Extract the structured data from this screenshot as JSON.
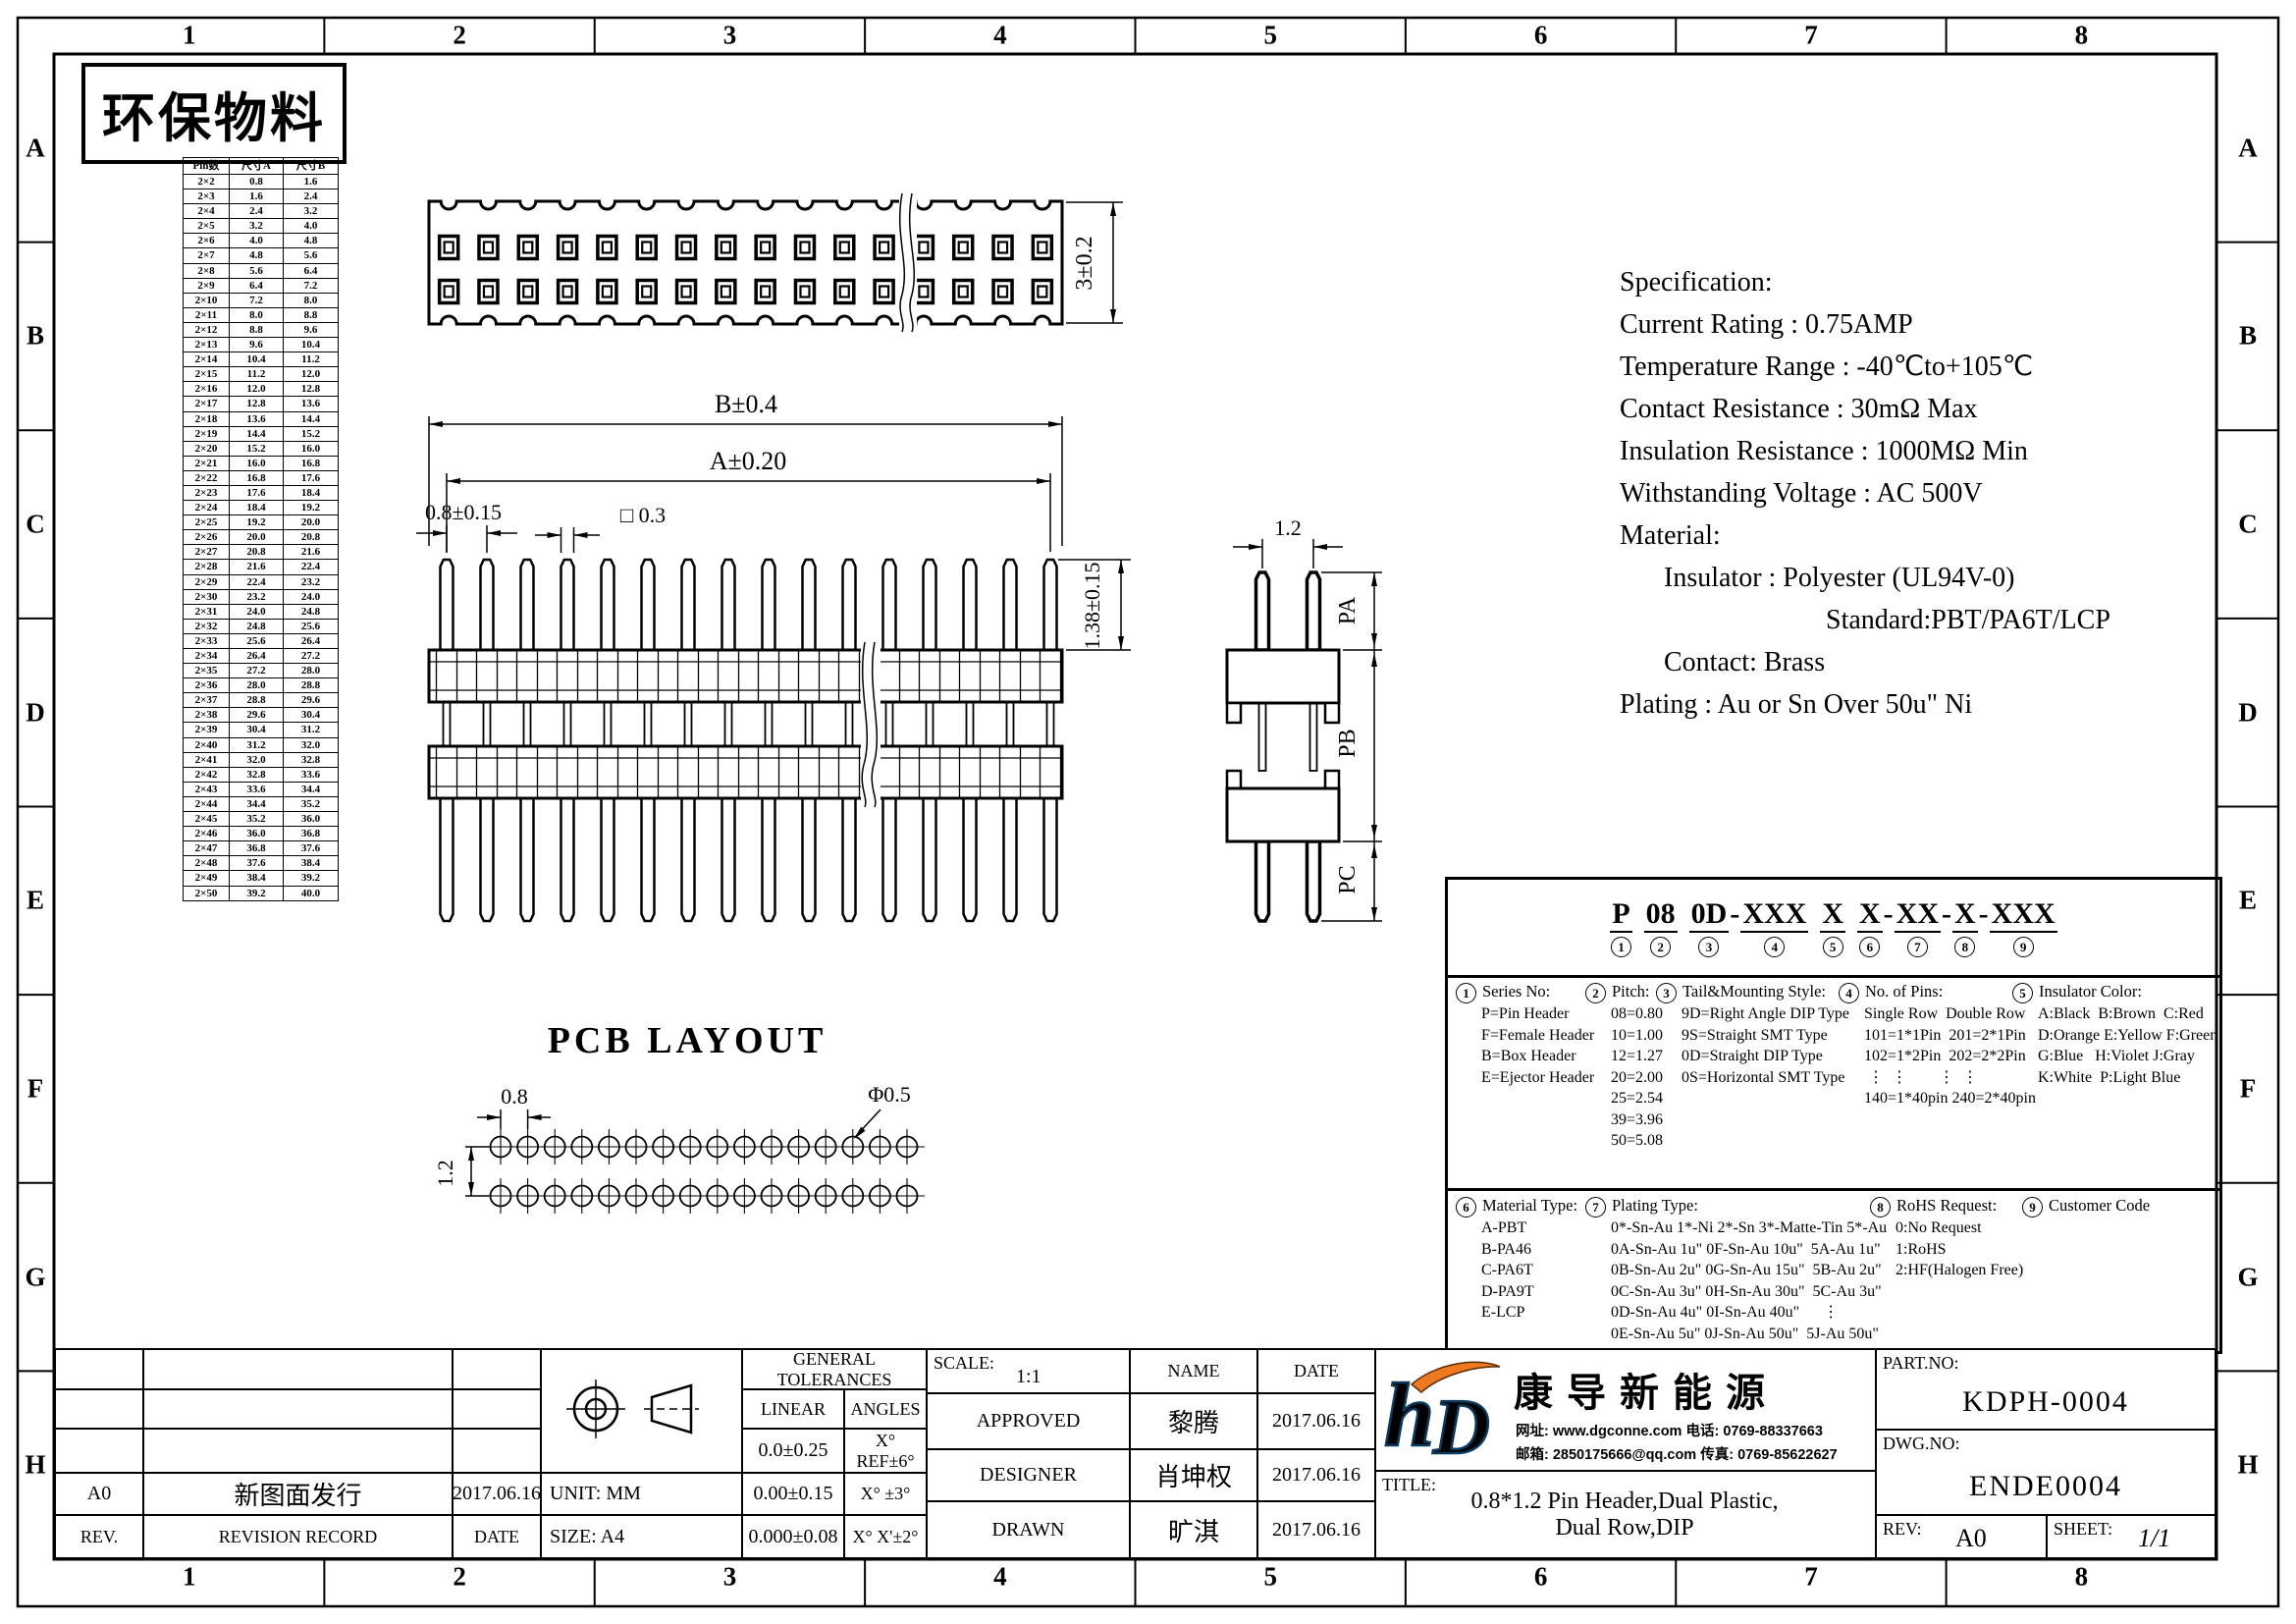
{
  "stamp": {
    "text": "环保物料"
  },
  "zones": {
    "columns": [
      "1",
      "2",
      "3",
      "4",
      "5",
      "6",
      "7",
      "8"
    ],
    "rows": [
      "A",
      "B",
      "C",
      "D",
      "E",
      "F",
      "G",
      "H"
    ]
  },
  "pin_table": {
    "headers": [
      "Pin数",
      "尺寸A",
      "尺寸B"
    ],
    "rows": [
      [
        "2×2",
        "0.8",
        "1.6"
      ],
      [
        "2×3",
        "1.6",
        "2.4"
      ],
      [
        "2×4",
        "2.4",
        "3.2"
      ],
      [
        "2×5",
        "3.2",
        "4.0"
      ],
      [
        "2×6",
        "4.0",
        "4.8"
      ],
      [
        "2×7",
        "4.8",
        "5.6"
      ],
      [
        "2×8",
        "5.6",
        "6.4"
      ],
      [
        "2×9",
        "6.4",
        "7.2"
      ],
      [
        "2×10",
        "7.2",
        "8.0"
      ],
      [
        "2×11",
        "8.0",
        "8.8"
      ],
      [
        "2×12",
        "8.8",
        "9.6"
      ],
      [
        "2×13",
        "9.6",
        "10.4"
      ],
      [
        "2×14",
        "10.4",
        "11.2"
      ],
      [
        "2×15",
        "11.2",
        "12.0"
      ],
      [
        "2×16",
        "12.0",
        "12.8"
      ],
      [
        "2×17",
        "12.8",
        "13.6"
      ],
      [
        "2×18",
        "13.6",
        "14.4"
      ],
      [
        "2×19",
        "14.4",
        "15.2"
      ],
      [
        "2×20",
        "15.2",
        "16.0"
      ],
      [
        "2×21",
        "16.0",
        "16.8"
      ],
      [
        "2×22",
        "16.8",
        "17.6"
      ],
      [
        "2×23",
        "17.6",
        "18.4"
      ],
      [
        "2×24",
        "18.4",
        "19.2"
      ],
      [
        "2×25",
        "19.2",
        "20.0"
      ],
      [
        "2×26",
        "20.0",
        "20.8"
      ],
      [
        "2×27",
        "20.8",
        "21.6"
      ],
      [
        "2×28",
        "21.6",
        "22.4"
      ],
      [
        "2×29",
        "22.4",
        "23.2"
      ],
      [
        "2×30",
        "23.2",
        "24.0"
      ],
      [
        "2×31",
        "24.0",
        "24.8"
      ],
      [
        "2×32",
        "24.8",
        "25.6"
      ],
      [
        "2×33",
        "25.6",
        "26.4"
      ],
      [
        "2×34",
        "26.4",
        "27.2"
      ],
      [
        "2×35",
        "27.2",
        "28.0"
      ],
      [
        "2×36",
        "28.0",
        "28.8"
      ],
      [
        "2×37",
        "28.8",
        "29.6"
      ],
      [
        "2×38",
        "29.6",
        "30.4"
      ],
      [
        "2×39",
        "30.4",
        "31.2"
      ],
      [
        "2×40",
        "31.2",
        "32.0"
      ],
      [
        "2×41",
        "32.0",
        "32.8"
      ],
      [
        "2×42",
        "32.8",
        "33.6"
      ],
      [
        "2×43",
        "33.6",
        "34.4"
      ],
      [
        "2×44",
        "34.4",
        "35.2"
      ],
      [
        "2×45",
        "35.2",
        "36.0"
      ],
      [
        "2×46",
        "36.0",
        "36.8"
      ],
      [
        "2×47",
        "36.8",
        "37.6"
      ],
      [
        "2×48",
        "37.6",
        "38.4"
      ],
      [
        "2×49",
        "38.4",
        "39.2"
      ],
      [
        "2×50",
        "39.2",
        "40.0"
      ]
    ]
  },
  "views": {
    "top": {
      "height_dim": "3±0.2"
    },
    "front": {
      "dim_b": "B±0.4",
      "dim_a": "A±0.20",
      "dim_pitch": "0.8±0.15",
      "dim_pin": "□ 0.3",
      "dim_h": "1.38±0.15"
    },
    "side": {
      "dim_w": "1.2",
      "dim_pa": "PA",
      "dim_pb": "PB",
      "dim_pc": "PC"
    },
    "pcb": {
      "title": "PCB  LAYOUT",
      "dim_pitch": "0.8",
      "dim_row": "1.2",
      "dim_hole": "Φ0.5"
    }
  },
  "spec": {
    "lines": [
      {
        "text": "Specification:",
        "indent": 0
      },
      {
        "text": "Current Rating : 0.75AMP",
        "indent": 0
      },
      {
        "text": "Temperature Range : -40℃to+105℃",
        "indent": 0
      },
      {
        "text": "Contact Resistance : 30mΩ Max",
        "indent": 0
      },
      {
        "text": "Insulation Resistance : 1000MΩ Min",
        "indent": 0
      },
      {
        "text": "Withstanding Voltage : AC 500V",
        "indent": 0
      },
      {
        "text": "Material:",
        "indent": 0
      },
      {
        "text": "Insulator : Polyester (UL94V-0)",
        "indent": 1
      },
      {
        "text": "Standard:PBT/PA6T/LCP",
        "indent": 2
      },
      {
        "text": "Contact: Brass",
        "indent": 1
      },
      {
        "text": "Plating : Au or Sn Over 50u\" Ni",
        "indent": 0
      }
    ]
  },
  "ordering": {
    "code_groups": [
      {
        "text": "P",
        "num": "1",
        "sep": " "
      },
      {
        "text": "08",
        "num": "2",
        "sep": " "
      },
      {
        "text": "0D",
        "num": "3",
        "sep": "-"
      },
      {
        "text": "XXX",
        "num": "4",
        "sep": " "
      },
      {
        "text": "X",
        "num": "5",
        "sep": " "
      },
      {
        "text": "X",
        "num": "6",
        "sep": "-"
      },
      {
        "text": "XX",
        "num": "7",
        "sep": "-"
      },
      {
        "text": "X",
        "num": "8",
        "sep": "-"
      },
      {
        "text": "XXX",
        "num": "9",
        "sep": ""
      }
    ],
    "series": {
      "num": "1",
      "title": "Series No:",
      "items": [
        "P=Pin Header",
        "F=Female Header",
        "B=Box Header",
        "E=Ejector Header"
      ]
    },
    "pitch": {
      "num": "2",
      "title": "Pitch:",
      "items": [
        "08=0.80",
        "10=1.00",
        "12=1.27",
        "20=2.00",
        "25=2.54",
        "39=3.96",
        "50=5.08"
      ]
    },
    "tail": {
      "num": "3",
      "title": "Tail&Mounting Style:",
      "items": [
        "9D=Right Angle DIP Type",
        "9S=Straight SMT Type",
        "0D=Straight DIP Type",
        "0S=Horizontal SMT Type"
      ]
    },
    "pins": {
      "num": "4",
      "title": "No. of Pins:",
      "lines": [
        "Single Row  Double Row",
        "101=1*1Pin  201=2*1Pin",
        "102=1*2Pin  202=2*2Pin",
        " ⋮  ⋮        ⋮  ⋮",
        "140=1*40pin 240=2*40pin"
      ]
    },
    "color": {
      "num": "5",
      "title": "Insulator Color:",
      "lines": [
        "A:Black  B:Brown  C:Red",
        "D:Orange E:Yellow F:Green",
        "G:Blue   H:Violet J:Gray",
        "K:White  P:Light Blue"
      ]
    },
    "material": {
      "num": "6",
      "title": "Material Type:",
      "items": [
        "A-PBT",
        "B-PA46",
        "C-PA6T",
        "D-PA9T",
        "E-LCP"
      ]
    },
    "plating": {
      "num": "7",
      "title": "Plating Type:",
      "lines": [
        "0*-Sn-Au 1*-Ni 2*-Sn 3*-Matte-Tin 5*-Au",
        "0A-Sn-Au 1u\" 0F-Sn-Au 10u\"  5A-Au 1u\"",
        "0B-Sn-Au 2u\" 0G-Sn-Au 15u\"  5B-Au 2u\"",
        "0C-Sn-Au 3u\" 0H-Sn-Au 30u\"  5C-Au 3u\"",
        "0D-Sn-Au 4u\" 0I-Sn-Au 40u\"      ⋮",
        "0E-Sn-Au 5u\" 0J-Sn-Au 50u\"  5J-Au 50u\""
      ]
    },
    "rohs": {
      "num": "8",
      "title": "RoHS Request:",
      "items": [
        "0:No Request",
        "1:RoHS",
        "2:HF(Halogen Free)"
      ]
    },
    "customer": {
      "num": "9",
      "title": "Customer Code"
    }
  },
  "title_block": {
    "revision": {
      "rev": "A0",
      "record": "新图面发行",
      "date": "2017.06.16",
      "rev_header": "REV.",
      "record_header": "REVISION RECORD",
      "date_header": "DATE"
    },
    "unit_label": "UNIT: MM",
    "size_label": "SIZE: A4",
    "tolerances": {
      "title": "GENERAL TOLERANCES",
      "linear_label": "LINEAR",
      "angles_label": "ANGLES",
      "rows": [
        [
          "0.0±0.25",
          "X° REF±6°"
        ],
        [
          "0.00±0.15",
          "X° ±3°"
        ],
        [
          "0.000±0.08",
          "X° X'±2°"
        ]
      ]
    },
    "scale_label": "SCALE:",
    "scale_value": "1:1",
    "name_header": "NAME",
    "date_header": "DATE",
    "sign_rows": [
      {
        "role": "APPROVED",
        "name": "黎腾",
        "date": "2017.06.16"
      },
      {
        "role": "DESIGNER",
        "name": "肖坤权",
        "date": "2017.06.16"
      },
      {
        "role": "DRAWN",
        "name": "旷淇",
        "date": "2017.06.16"
      }
    ],
    "company": {
      "name": "康导新能源",
      "contact1": "网址: www.dgconne.com   电话: 0769-88337663",
      "contact2": "邮箱: 2850175666@qq.com 传真: 0769-85622627"
    },
    "title_label": "TITLE:",
    "title_line1": "0.8*1.2 Pin Header,Dual Plastic,",
    "title_line2": "Dual Row,DIP",
    "part_no_label": "PART.NO:",
    "part_no": "KDPH-0004",
    "dwg_no_label": "DWG.NO:",
    "dwg_no": "ENDE0004",
    "rev_label": "REV:",
    "rev": "A0",
    "sheet_label": "SHEET:",
    "sheet": "1/1"
  },
  "colors": {
    "line": "#000000",
    "logo_blue": "#29b1e8",
    "logo_orange": "#ee7920"
  }
}
